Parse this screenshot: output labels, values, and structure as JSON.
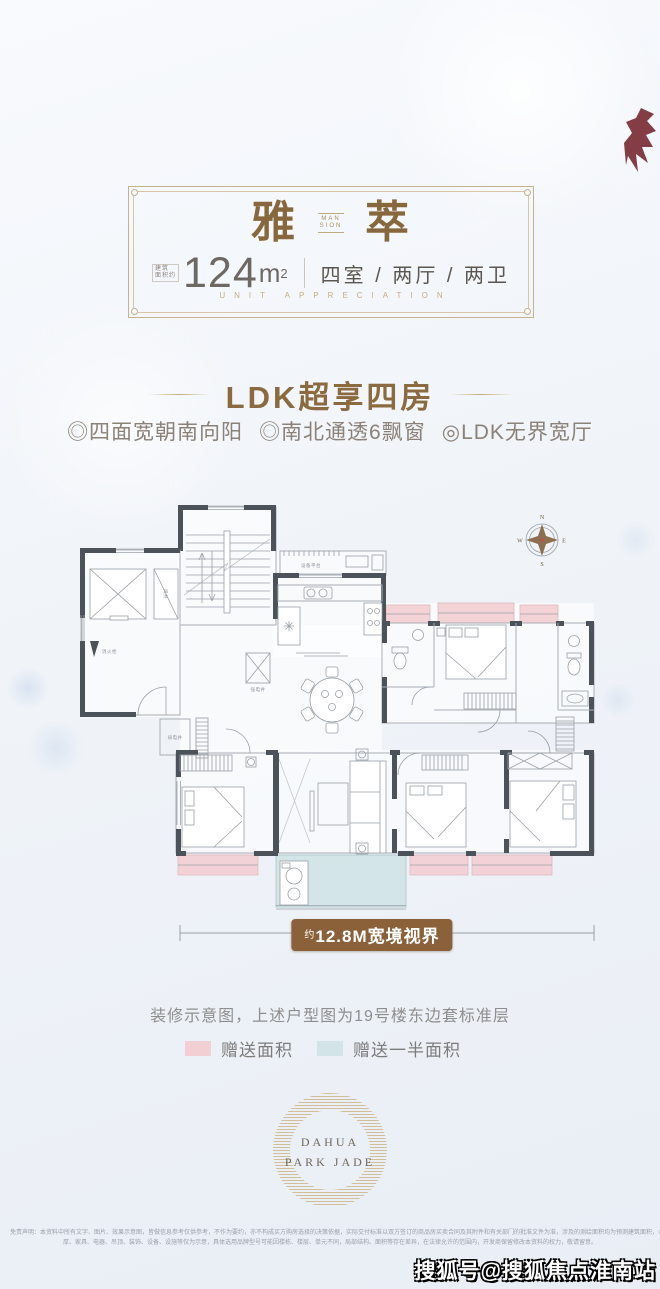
{
  "badge": {
    "title_left": "雅",
    "emblem_top": "MAN",
    "emblem_bottom": "SION",
    "title_right": "萃",
    "area_prefix_line1": "建筑",
    "area_prefix_line2": "面积约",
    "area_value": "124",
    "area_unit": "m",
    "area_exponent": "2",
    "rooms": "四室 / 两厅 / 两卫",
    "subtitle": "UNIT APPRECIATION"
  },
  "section": {
    "title": "LDK超享四房",
    "bullets": [
      "◎四面宽朝南向阳",
      "◎南北通透6飘窗",
      "◎LDK无界宽厅"
    ]
  },
  "floorplan": {
    "labels": {
      "equipment_platform": "设备平台",
      "wind_shaft": "风井",
      "fire_hydrant": "消火栓",
      "strong_elec_shaft": "强电井",
      "weak_elec_shaft": "弱电井"
    },
    "compass": {
      "n": "N",
      "e": "E",
      "s": "S",
      "w": "W"
    },
    "colors": {
      "wall": "#4c525a",
      "thin_line": "#a9aeb5",
      "gift_area": "#f2cfd2",
      "half_gift_area": "#d2e4e7"
    }
  },
  "dimension": {
    "prefix": "约",
    "label": "12.8M宽境视界",
    "banner_color": "#8a6138"
  },
  "note": {
    "text": "装修示意图，上述户型图为19号楼东边套标准层"
  },
  "legend": {
    "items": [
      {
        "label": "赠送面积",
        "color": "#f2cfd2"
      },
      {
        "label": "赠送一半面积",
        "color": "#d2e4e7"
      }
    ]
  },
  "logo": {
    "line1": "DAHUA",
    "line2": "PARK JADE"
  },
  "disclaimer": {
    "line1": "免责声明：本资料中所有文字、图片、效果示意图，皆做信息参考仅供参考，不作为要约，亦不构成买方购房选择的决策依据，实际交付标准以双方签订的商品房买卖合同及其附件和有关部门的批准文件为准，涉及的测绘面积均为预测建筑面积，本资料所示的结构、面积、尺寸、空间、墙",
    "line2": "厚、家具、电器、吊顶、装饰、设备、设施等仅为示意，具体选用品牌型号可能因楼栋、楼层、单元不同，局部结构、面积等存在差异，在法律允许的范围内，开发商保留修改本资料的权力，敬请留意。"
  },
  "watermark": {
    "text": "搜狐号@搜狐焦点淮南站"
  },
  "accent_colors": {
    "gold": "#8a6a3e",
    "banner_brown": "#8a6138",
    "sohu_red": "#76242c"
  }
}
